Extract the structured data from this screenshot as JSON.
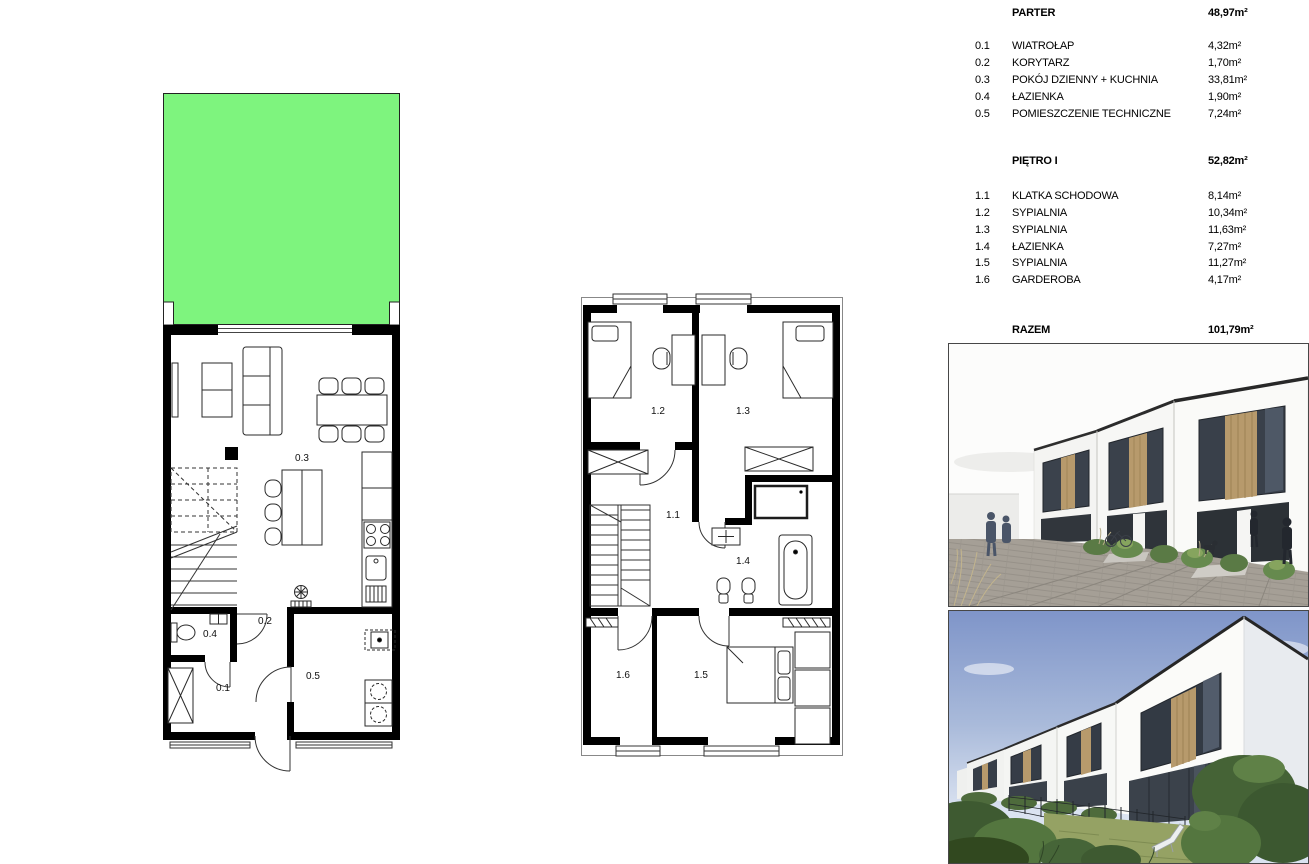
{
  "legend": {
    "sections": [
      {
        "title": "PARTER",
        "area": "48,97m²",
        "rooms": [
          {
            "no": "0.1",
            "name": "WIATROŁAP",
            "area": "4,32m²"
          },
          {
            "no": "0.2",
            "name": "KORYTARZ",
            "area": "1,70m²"
          },
          {
            "no": "0.3",
            "name": "POKÓJ DZIENNY + KUCHNIA",
            "area": "33,81m²"
          },
          {
            "no": "0.4",
            "name": "ŁAZIENKA",
            "area": "1,90m²"
          },
          {
            "no": "0.5",
            "name": "POMIESZCZENIE TECHNICZNE",
            "area": "7,24m²"
          }
        ]
      },
      {
        "title": "PIĘTRO I",
        "area": "52,82m²",
        "rooms": [
          {
            "no": "1.1",
            "name": "KLATKA SCHODOWA",
            "area": "8,14m²"
          },
          {
            "no": "1.2",
            "name": "SYPIALNIA",
            "area": "10,34m²"
          },
          {
            "no": "1.3",
            "name": "SYPIALNIA",
            "area": "11,63m²"
          },
          {
            "no": "1.4",
            "name": "ŁAZIENKA",
            "area": "7,27m²"
          },
          {
            "no": "1.5",
            "name": "SYPIALNIA",
            "area": "11,27m²"
          },
          {
            "no": "1.6",
            "name": "GARDEROBA",
            "area": "4,17m²"
          }
        ]
      }
    ],
    "total": {
      "label": "RAZEM",
      "area": "101,79m²"
    }
  },
  "plan_labels": {
    "g01": "0.1",
    "g02": "0.2",
    "g03": "0.3",
    "g04": "0.4",
    "g05": "0.5",
    "f11": "1.1",
    "f12": "1.2",
    "f13": "1.3",
    "f14": "1.4",
    "f15": "1.5",
    "f16": "1.6"
  },
  "colors": {
    "garden_green": "#7ef47e",
    "wood_accent": "#b79a6c",
    "sky_blue": "#7f95c9",
    "wall": "#000000"
  }
}
